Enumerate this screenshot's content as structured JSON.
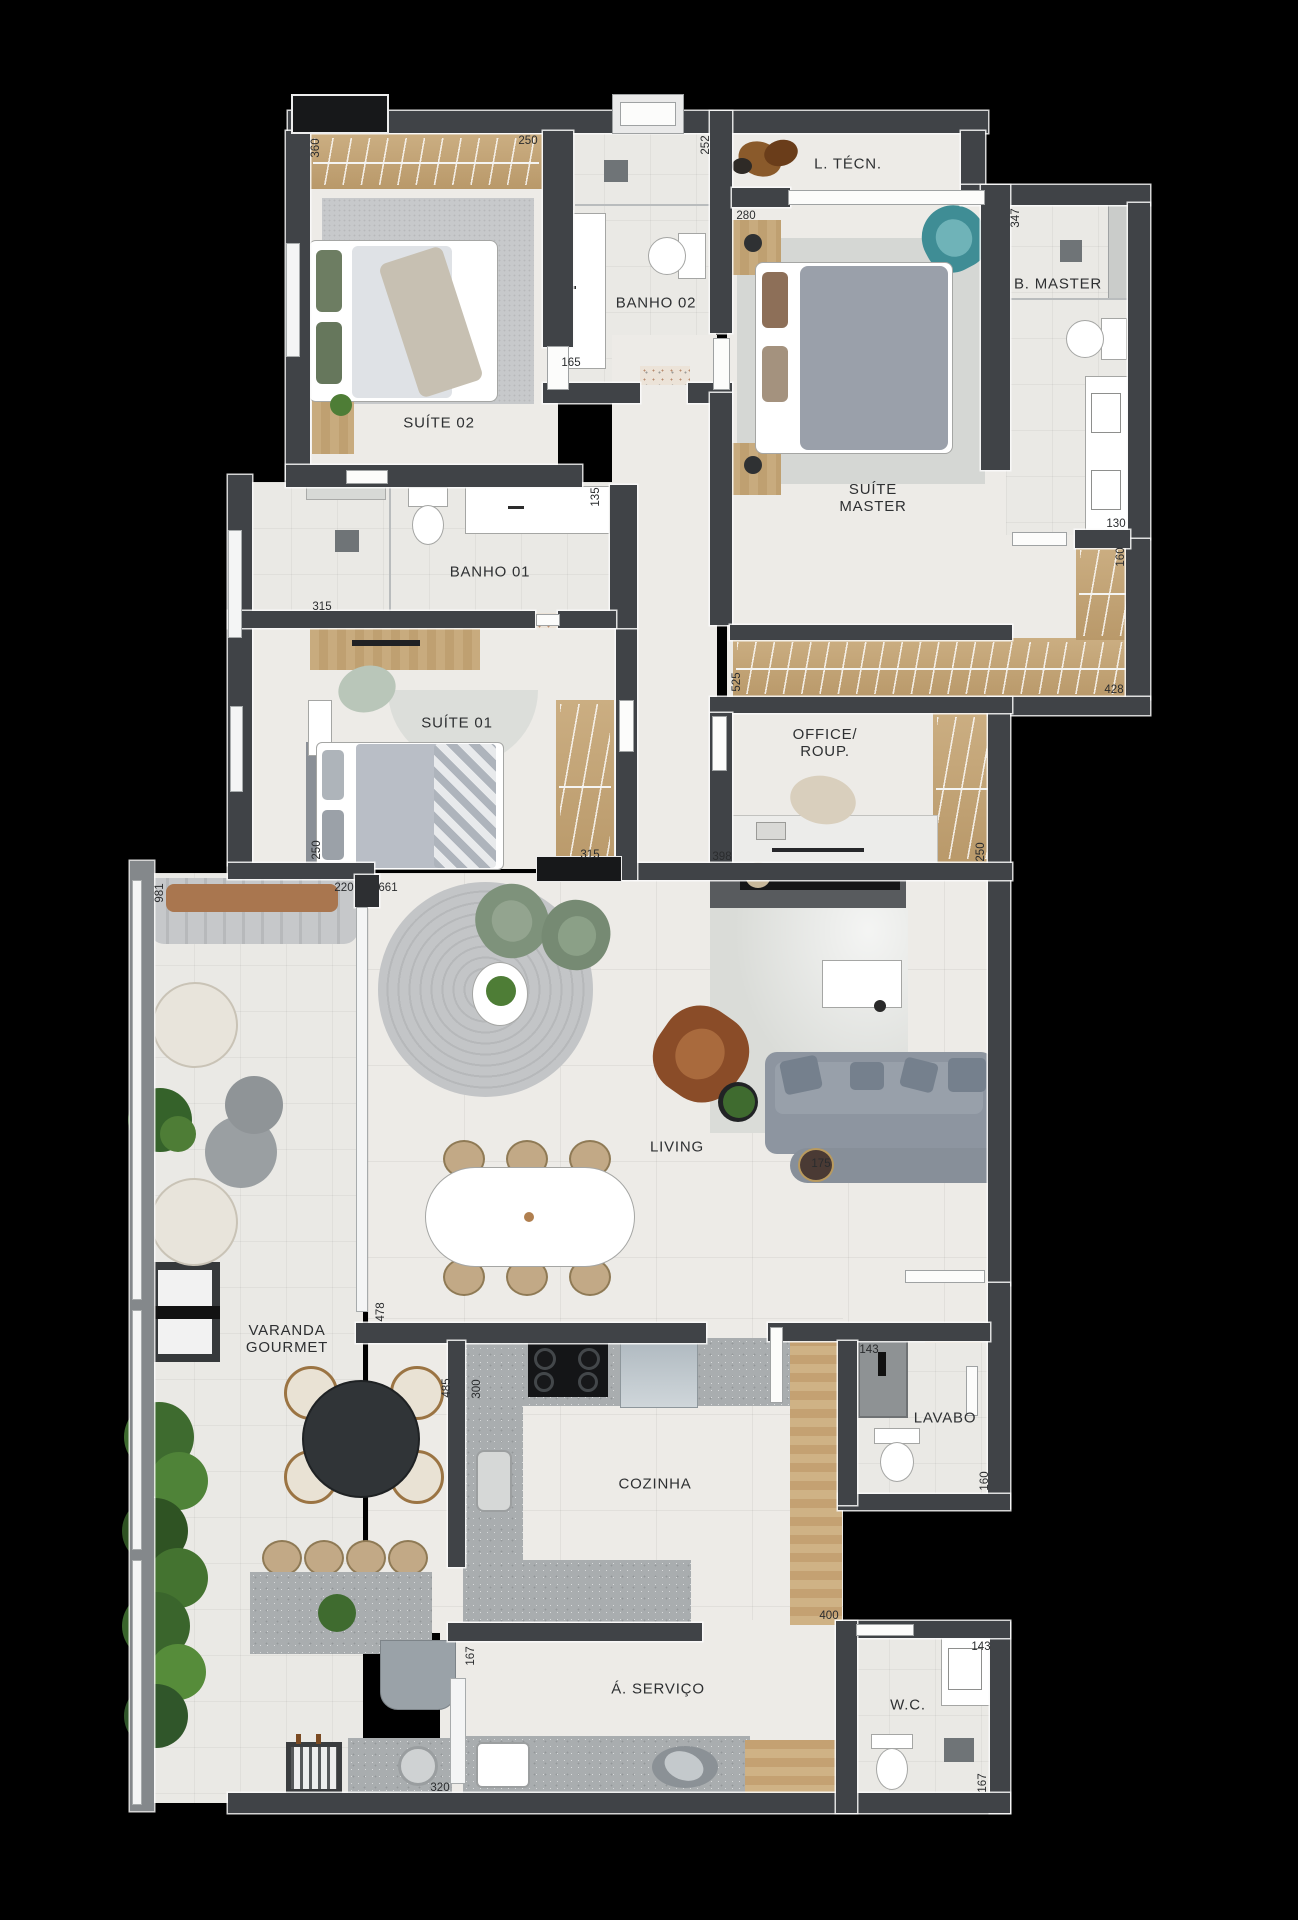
{
  "plan": {
    "palette": {
      "background": "#000000",
      "wall": "#404347",
      "floor": "#edebe7",
      "wood": "#c8ab7e",
      "stone": "#a9adaf",
      "accent_teal": "#3f8d95",
      "accent_green": "#7e927b",
      "label_color": "#2e3032"
    },
    "rooms": [
      {
        "id": "suite-02",
        "lines": [
          "SUÍTE 02"
        ],
        "x": 439,
        "y": 423
      },
      {
        "id": "banho-02",
        "lines": [
          "BANHO 02"
        ],
        "x": 656,
        "y": 303
      },
      {
        "id": "l-tecn",
        "lines": [
          "L. TÉCN."
        ],
        "x": 848,
        "y": 164
      },
      {
        "id": "suite-master",
        "lines": [
          "SUÍTE",
          "MASTER"
        ],
        "x": 873,
        "y": 498
      },
      {
        "id": "b-master",
        "lines": [
          "B. MASTER"
        ],
        "x": 1058,
        "y": 284
      },
      {
        "id": "banho-01",
        "lines": [
          "BANHO 01"
        ],
        "x": 490,
        "y": 572
      },
      {
        "id": "suite-01",
        "lines": [
          "SUÍTE 01"
        ],
        "x": 457,
        "y": 723
      },
      {
        "id": "office-roup",
        "lines": [
          "OFFICE/",
          "ROUP."
        ],
        "x": 825,
        "y": 743
      },
      {
        "id": "living",
        "lines": [
          "LIVING"
        ],
        "x": 677,
        "y": 1147
      },
      {
        "id": "varanda-gourmet",
        "lines": [
          "VARANDA",
          "GOURMET"
        ],
        "x": 287,
        "y": 1339
      },
      {
        "id": "cozinha",
        "lines": [
          "COZINHA"
        ],
        "x": 655,
        "y": 1484
      },
      {
        "id": "lavabo",
        "lines": [
          "LAVABO"
        ],
        "x": 945,
        "y": 1418
      },
      {
        "id": "a-servico",
        "lines": [
          "Á. SERVIÇO"
        ],
        "x": 658,
        "y": 1689
      },
      {
        "id": "wc",
        "lines": [
          "W.C."
        ],
        "x": 908,
        "y": 1705
      }
    ],
    "dimensions": [
      {
        "v": "360",
        "x": 316,
        "y": 148,
        "o": "v"
      },
      {
        "v": "250",
        "x": 528,
        "y": 141,
        "o": "h"
      },
      {
        "v": "252",
        "x": 706,
        "y": 145,
        "o": "v"
      },
      {
        "v": "280",
        "x": 746,
        "y": 216,
        "o": "h"
      },
      {
        "v": "347",
        "x": 1016,
        "y": 218,
        "o": "v"
      },
      {
        "v": "165",
        "x": 571,
        "y": 363,
        "o": "h"
      },
      {
        "v": "135",
        "x": 596,
        "y": 497,
        "o": "v"
      },
      {
        "v": "130",
        "x": 1116,
        "y": 524,
        "o": "h"
      },
      {
        "v": "160",
        "x": 1121,
        "y": 557,
        "o": "v"
      },
      {
        "v": "315",
        "x": 322,
        "y": 607,
        "o": "h"
      },
      {
        "v": "525",
        "x": 737,
        "y": 682,
        "o": "v"
      },
      {
        "v": "428",
        "x": 1114,
        "y": 690,
        "o": "h"
      },
      {
        "v": "250",
        "x": 981,
        "y": 852,
        "o": "v"
      },
      {
        "v": "315",
        "x": 590,
        "y": 855,
        "o": "h"
      },
      {
        "v": "398",
        "x": 722,
        "y": 857,
        "o": "h"
      },
      {
        "v": "250",
        "x": 317,
        "y": 850,
        "o": "v"
      },
      {
        "v": "981",
        "x": 160,
        "y": 893,
        "o": "v"
      },
      {
        "v": "220",
        "x": 344,
        "y": 888,
        "o": "h"
      },
      {
        "v": "661",
        "x": 388,
        "y": 888,
        "o": "h"
      },
      {
        "v": "175",
        "x": 821,
        "y": 1164,
        "o": "h"
      },
      {
        "v": "478",
        "x": 381,
        "y": 1312,
        "o": "v"
      },
      {
        "v": "485",
        "x": 447,
        "y": 1388,
        "o": "v"
      },
      {
        "v": "300",
        "x": 477,
        "y": 1389,
        "o": "v"
      },
      {
        "v": "143",
        "x": 869,
        "y": 1350,
        "o": "h"
      },
      {
        "v": "160",
        "x": 985,
        "y": 1481,
        "o": "v"
      },
      {
        "v": "400",
        "x": 829,
        "y": 1616,
        "o": "h"
      },
      {
        "v": "167",
        "x": 471,
        "y": 1656,
        "o": "v"
      },
      {
        "v": "143",
        "x": 981,
        "y": 1647,
        "o": "h"
      },
      {
        "v": "320",
        "x": 440,
        "y": 1788,
        "o": "h"
      },
      {
        "v": "167",
        "x": 983,
        "y": 1783,
        "o": "v"
      }
    ]
  }
}
